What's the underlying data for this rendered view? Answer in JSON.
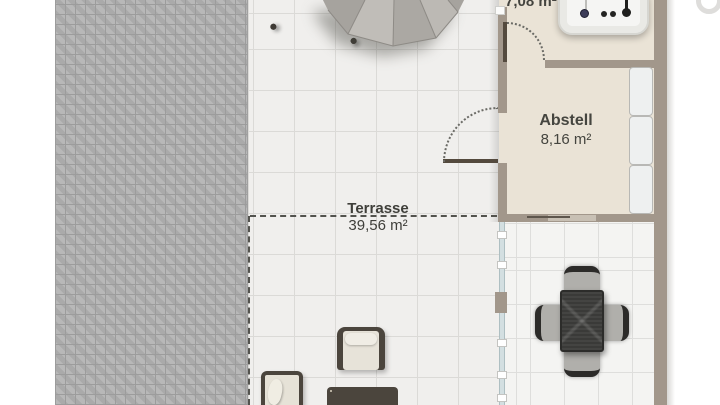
{
  "plan": {
    "terrace": {
      "name": "Terrasse",
      "area": "39,56 m²"
    },
    "storage": {
      "name": "Abstell",
      "area": "8,16 m²"
    },
    "utility": {
      "area": "7,08 m²"
    }
  },
  "furniture": {
    "parasol": "parasol",
    "sun_loungers": 2,
    "armchairs": 2,
    "sofa_cushions": 4,
    "dining_chairs": 4,
    "shelf_boxes": 3,
    "appliance": "boiler-unit"
  },
  "colors": {
    "wall": "#a2978b",
    "paving": "#b3b3b3",
    "room_floor": "#eae3d6",
    "terrace_tile": "#f0efed",
    "glass": "#d3dfe1",
    "dashed_boundary": "#53534e",
    "table": "#3a3a38",
    "door_leaf": "#544a3e"
  }
}
